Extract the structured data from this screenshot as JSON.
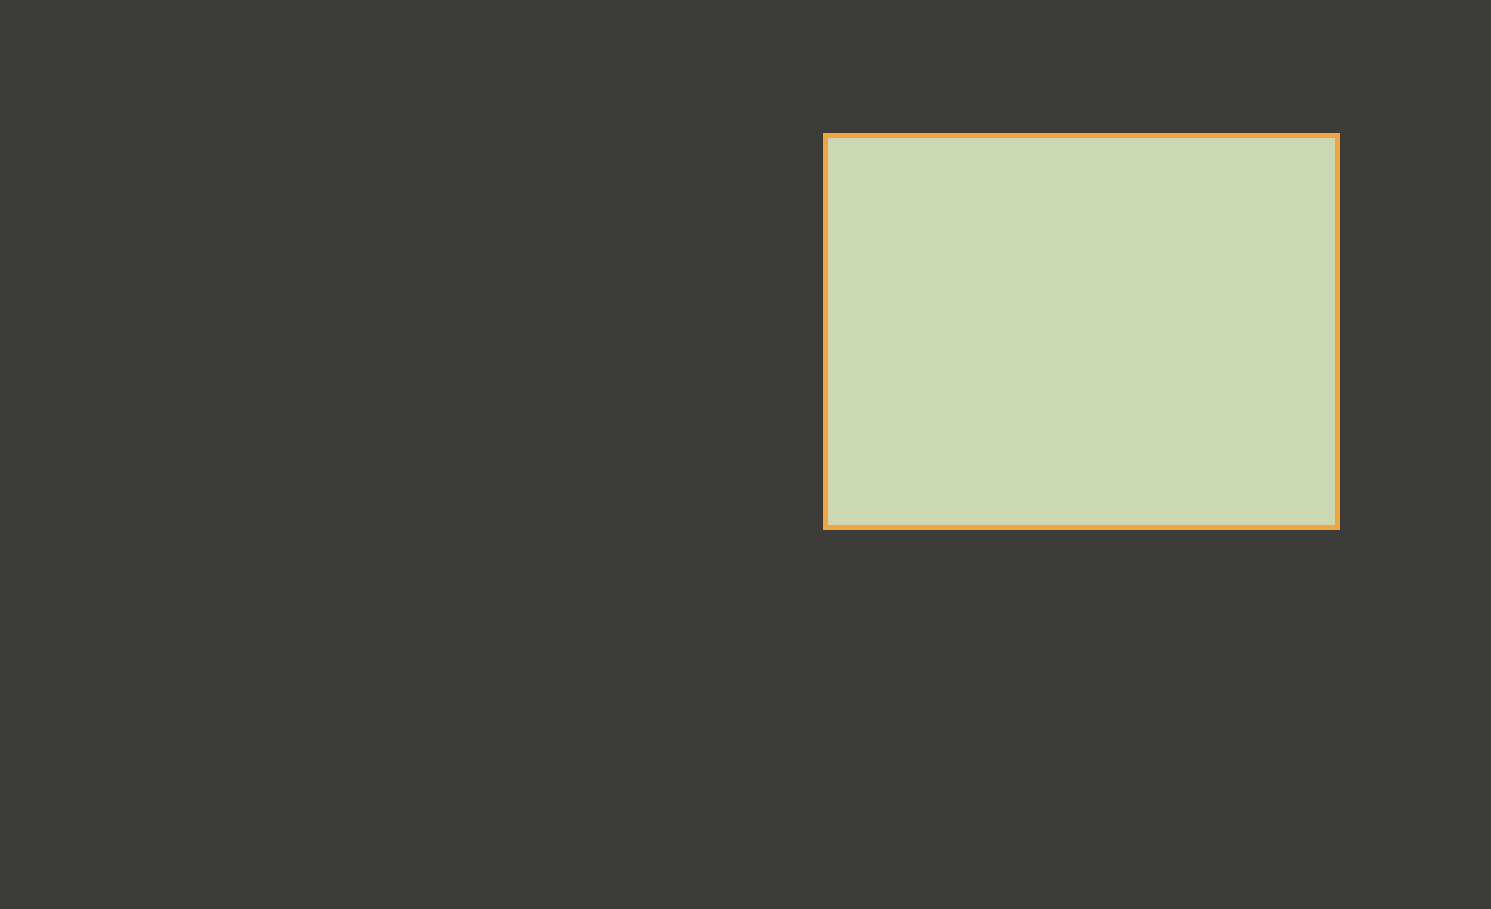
{
  "colors": {
    "accent_border": "#f0a63c",
    "marker_fill": "#f7b52b",
    "marker_halo": "#7d6829",
    "connector": "#e3c34a",
    "boundary_red": "#e2201c",
    "info_text": "#f1f1ee"
  },
  "info": {
    "dash": "——",
    "rows": [
      {
        "label": "项目名称",
        "value": "厦门鼓浪别墅酒店"
      },
      {
        "label": "项目地点",
        "value": "位于厦门 鼓浪屿区 鼓声路14号"
      },
      {
        "label": "所属商圈",
        "value": "鼓浪屿风景区"
      },
      {
        "label": "周围景观",
        "value": "鼓浪石 日光岩 百鸟园 钢琴博物馆 皓月园"
      }
    ]
  },
  "site_plan": {
    "road_label": "鼓声路",
    "entrance_label": "景区入口",
    "legend_title": "总平面图",
    "legend_scale": "1:200",
    "north_label": "北",
    "labels": {
      "main_building": "综合楼",
      "guest_rooms": "假日客房",
      "resort_center": "度假酒店中心",
      "floor": "2F"
    }
  }
}
